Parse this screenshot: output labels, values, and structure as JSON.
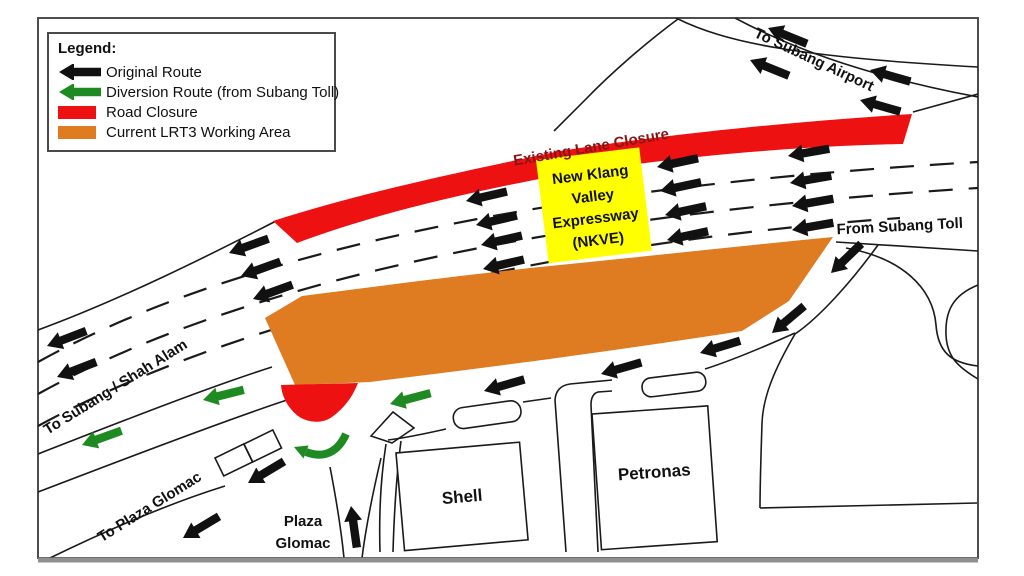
{
  "colors": {
    "original_route": "#111111",
    "diversion_route": "#1f8a22",
    "road_closure": "#ee1111",
    "working_area": "#df7b20",
    "nkve_box": "#ffff00",
    "lane_closure_text": "#8a1414"
  },
  "legend": {
    "title": "Legend:",
    "items": [
      {
        "id": "original-route",
        "label": "Original Route",
        "icon": "black-arrow",
        "color": "#111111"
      },
      {
        "id": "diversion-route",
        "label": "Diversion Route (from Subang Toll)",
        "icon": "green-arrow",
        "color": "#1f8a22"
      },
      {
        "id": "road-closure",
        "label": "Road Closure",
        "icon": "red-swatch",
        "color": "#ee1111"
      },
      {
        "id": "working-area",
        "label": "Current LRT3 Working Area",
        "icon": "orange-swatch",
        "color": "#df7b20"
      }
    ]
  },
  "map_labels": {
    "to_subang_airport": "To Subang Airport",
    "existing_lane_closure": "Existing Lane Closure",
    "nkve": {
      "line1": "New Klang",
      "line2": "Valley",
      "line3": "Expressway",
      "line4": "(NKVE)"
    },
    "from_subang_toll": "From Subang Toll",
    "to_subang_shah_alam": "To Subang / Shah Alam",
    "to_plaza_glomac": "To Plaza Glomac",
    "plaza_glomac": {
      "line1": "Plaza",
      "line2": "Glomac"
    },
    "shell": "Shell",
    "petronas": "Petronas"
  }
}
